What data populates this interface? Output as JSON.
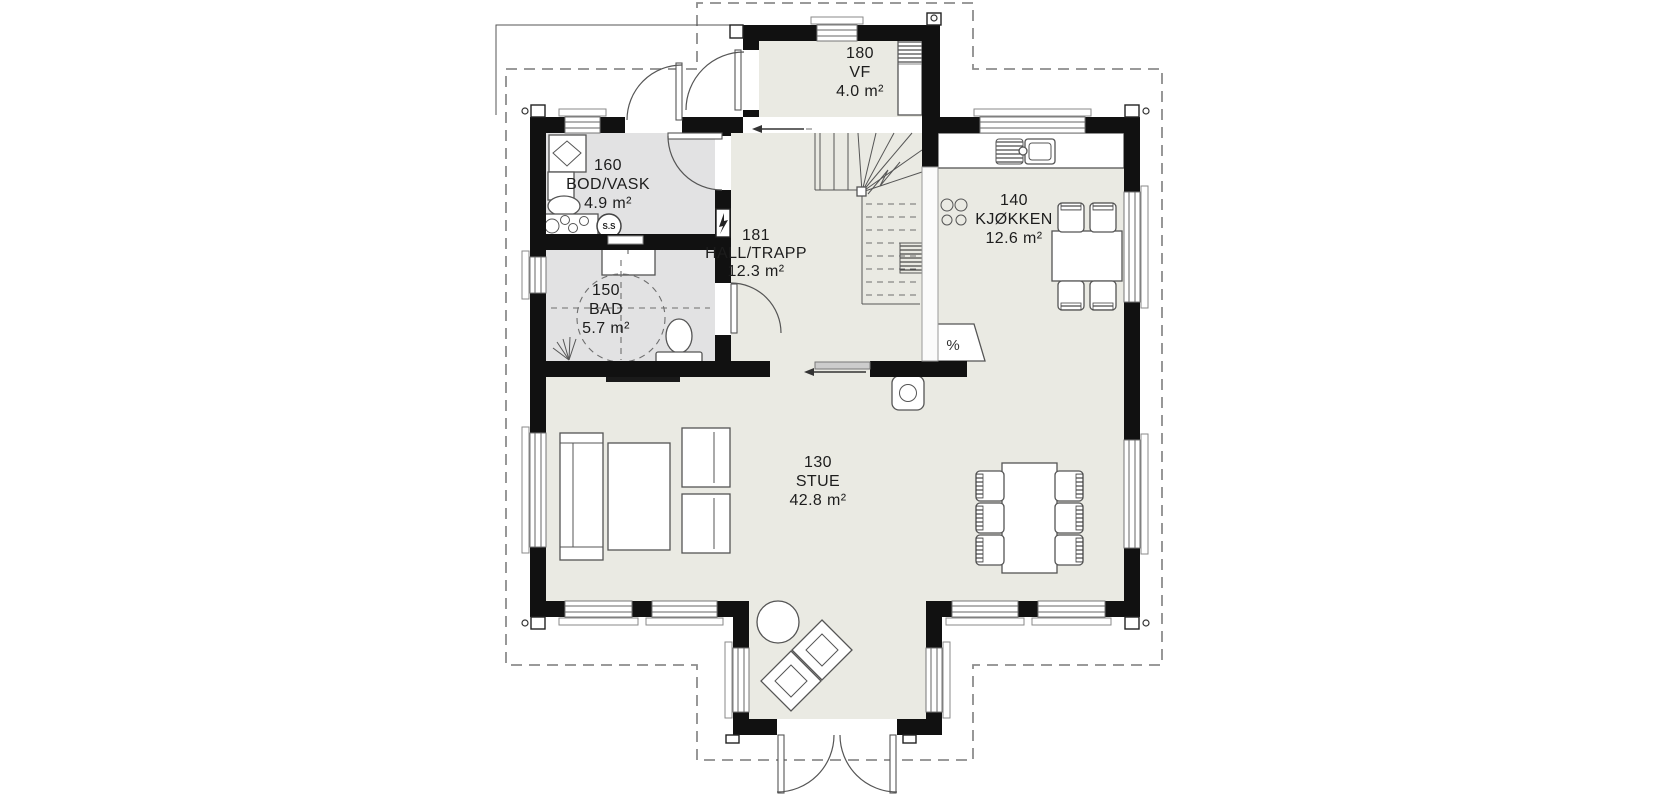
{
  "drawing": {
    "type": "floor-plan",
    "floor": "main floor"
  },
  "rooms": [
    {
      "id": "stue",
      "number": "130",
      "name": "STUE",
      "area": "42.8 m²"
    },
    {
      "id": "kjokken",
      "number": "140",
      "name": "KJØKKEN",
      "area": "12.6 m²"
    },
    {
      "id": "bad",
      "number": "150",
      "name": "BAD",
      "area": "5.7 m²"
    },
    {
      "id": "bod_vask",
      "number": "160",
      "name": "BOD/VASK",
      "area": "4.9 m²"
    },
    {
      "id": "vf",
      "number": "180",
      "name": "VF",
      "area": "4.0 m²"
    },
    {
      "id": "hall_trapp",
      "number": "181",
      "name": "HALL/TRAPP",
      "area": "12.3 m²"
    }
  ],
  "annotations": {
    "hot_water_tank": "S.S",
    "dishwasher_symbol": "%"
  },
  "colors": {
    "background": "#ffffff",
    "wall": "#111111",
    "floor": "#eaeae3",
    "wet_room_floor": "#e2e2e3",
    "furniture_outline": "#555555",
    "roof_overhang_dash": "#8c8c8c",
    "label_text": "#1d1d1d"
  }
}
